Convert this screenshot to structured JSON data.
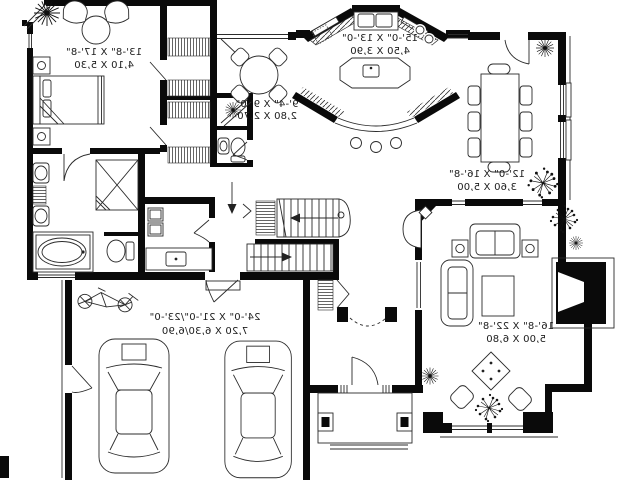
{
  "document": {
    "type": "house floor plan drawing",
    "text_orientation": "mirrored"
  },
  "rooms": {
    "master_bedroom": {
      "imperial": "13'-8\" X 17'-8\"",
      "metric": "4,10 X 5,30"
    },
    "kitchen": {
      "imperial": "15'-0\" X 13'-0\"",
      "metric": "4,50 X 3,90"
    },
    "breakfast_nook": {
      "imperial": "9'-4\" X 9'-0\"",
      "metric": "2,80 X 2,70"
    },
    "dining_room": {
      "imperial": "12'-0\" X 16'-8\"",
      "metric": "3,60 X 5,00"
    },
    "living_room": {
      "imperial": "16'-8\" X 22'-8\"",
      "metric": "5,00 X 6,80"
    },
    "garage": {
      "imperial": "24'-0\" X 21'-0\"/23'-0\"",
      "metric": "7,20 X 6,30/6,90"
    }
  },
  "colors": {
    "walls": "#0a0a0a",
    "lines": "#2b2b2b",
    "background": "#ffffff"
  }
}
